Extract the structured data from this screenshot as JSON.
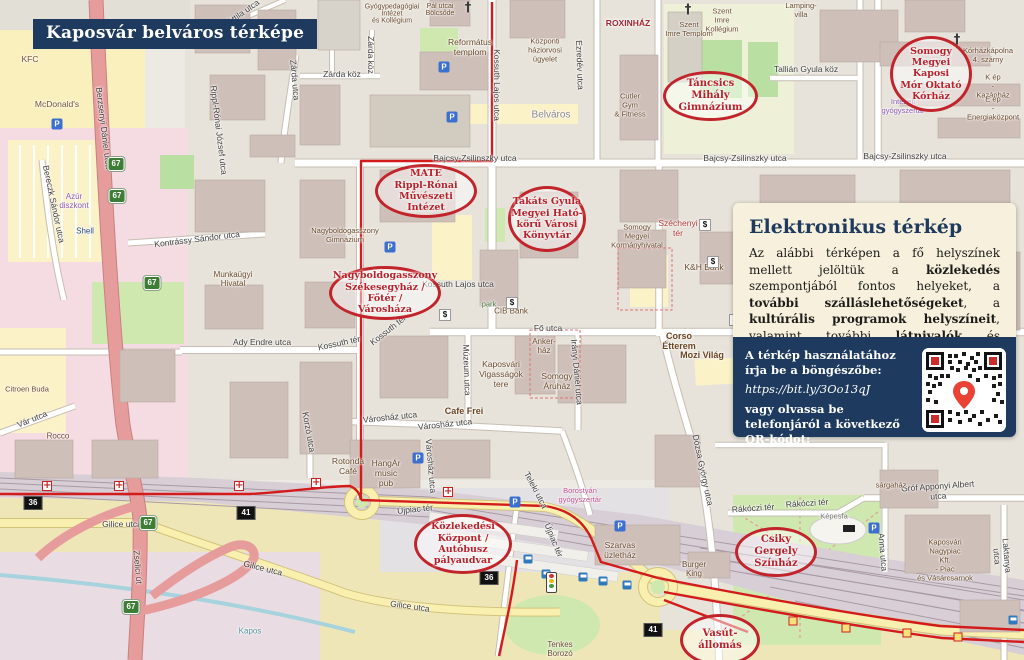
{
  "banner": {
    "title": "Kaposvár belváros térképe"
  },
  "panel": {
    "heading": "Elektronikus térkép",
    "body_segments": [
      {
        "t": "Az alábbi térképen a fő helyszínek mellett jelöltük a "
      },
      {
        "t": "közlekedés",
        "b": 1
      },
      {
        "t": " szempontjából fontos helyeket, a "
      },
      {
        "t": "további szálláslehetőségeket",
        "b": 1
      },
      {
        "t": ", a "
      },
      {
        "t": "kultúrális programok helyszíneit",
        "b": 1
      },
      {
        "t": ", valamint további "
      },
      {
        "t": "látnivalók",
        "b": 1
      },
      {
        "t": " és "
      },
      {
        "t": "élelmiszerüzletek",
        "b": 1
      },
      {
        "t": " címeit."
      }
    ],
    "footer": {
      "line1": "A térkép használatához írja be a böngészőbe:",
      "url": "https://bit.ly/3Oo13qJ",
      "line2": "vagy olvassa be telefonjáról a következő QR-kódot:"
    }
  },
  "colors": {
    "navy": "#1e3a5e",
    "panel_bg": "#f7f0dc",
    "callout_red": "#c2242b",
    "route_red": "#d31b1b",
    "shield_green": "#3e7d35",
    "shield_black": "#111111"
  },
  "map": {
    "glyphs": {
      "parking": "P",
      "atm": "$",
      "church": "†",
      "crossing": "+"
    },
    "callouts": [
      {
        "id": "korhaz",
        "x": 890,
        "y": 36,
        "w": 82,
        "h": 76,
        "fs": 9.5,
        "lines": [
          "Somogy",
          "Megyei Kaposi",
          "Mór Oktató",
          "Kórház"
        ]
      },
      {
        "id": "tancsics",
        "x": 663,
        "y": 71,
        "w": 95,
        "h": 50,
        "fs": 10,
        "lines": [
          "Táncsics Mihály",
          "Gimnázium"
        ]
      },
      {
        "id": "mate",
        "x": 375,
        "y": 164,
        "w": 102,
        "h": 54,
        "fs": 9.5,
        "lines": [
          "MATE",
          "Rippl-Rónai Művészeti",
          "Intézet"
        ]
      },
      {
        "id": "konyvtar",
        "x": 508,
        "y": 186,
        "w": 78,
        "h": 66,
        "fs": 9.5,
        "lines": [
          "Takáts Gyula",
          "Megyei Ható-",
          "körű Városi",
          "Könyvtár"
        ]
      },
      {
        "id": "szekesegyhaz",
        "x": 329,
        "y": 266,
        "w": 112,
        "h": 54,
        "fs": 9.5,
        "lines": [
          "Nagyboldogasszony",
          "Székesegyház / Főtér /",
          "Városháza"
        ]
      },
      {
        "id": "kozlekedesi",
        "x": 414,
        "y": 514,
        "w": 98,
        "h": 60,
        "fs": 9.5,
        "lines": [
          "Közlekedési",
          "Központ / Autóbusz",
          "pályaudvar"
        ]
      },
      {
        "id": "szinhaz",
        "x": 735,
        "y": 527,
        "w": 82,
        "h": 50,
        "fs": 10,
        "lines": [
          "Csiky Gergely",
          "Színház"
        ]
      },
      {
        "id": "vasut",
        "x": 680,
        "y": 614,
        "w": 80,
        "h": 52,
        "fs": 10,
        "lines": [
          "Vasút-",
          "állomás"
        ]
      }
    ],
    "streets": [
      {
        "t": "Bajcsy-Zsilinszky utca",
        "x": 475,
        "y": 158,
        "rot": 0
      },
      {
        "t": "Bajcsy-Zsilinszky utca",
        "x": 745,
        "y": 158,
        "rot": 0
      },
      {
        "t": "Bajcsy-Zsilinszky utca",
        "x": 905,
        "y": 156,
        "rot": 0
      },
      {
        "t": "Kossuth Lajos utca",
        "x": 497,
        "y": 85,
        "rot": 90
      },
      {
        "t": "Kossuth Lajos utca",
        "x": 458,
        "y": 284,
        "rot": 0
      },
      {
        "t": "Zárda utca",
        "x": 295,
        "y": 80,
        "rot": 85
      },
      {
        "t": "Zárda köz",
        "x": 342,
        "y": 74,
        "rot": 0
      },
      {
        "t": "Zárda köz",
        "x": 371,
        "y": 55,
        "rot": 90
      },
      {
        "t": "Fő utca",
        "x": 548,
        "y": 328,
        "rot": 0
      },
      {
        "t": "Kossuth tér",
        "x": 339,
        "y": 343,
        "rot": -12
      },
      {
        "t": "Kossuth tér",
        "x": 388,
        "y": 330,
        "rot": -38
      },
      {
        "t": "Ady Endre utca",
        "x": 262,
        "y": 342,
        "rot": 0
      },
      {
        "t": "Kontrássy Sándor utca",
        "x": 197,
        "y": 239,
        "rot": -7
      },
      {
        "t": "Berzsenyi Dániel utca",
        "x": 104,
        "y": 128,
        "rot": 83
      },
      {
        "t": "Bereczk Sándor utca",
        "x": 54,
        "y": 204,
        "rot": 78
      },
      {
        "t": "Rippl-Rónai József utca",
        "x": 219,
        "y": 130,
        "rot": 83
      },
      {
        "t": "Attila utca",
        "x": 243,
        "y": 12,
        "rot": -35
      },
      {
        "t": "Ezredév utca",
        "x": 580,
        "y": 65,
        "rot": 88
      },
      {
        "t": "Tallián Gyula köz",
        "x": 806,
        "y": 69,
        "rot": 0
      },
      {
        "t": "Irányi Dániel utca",
        "x": 577,
        "y": 372,
        "rot": 85
      },
      {
        "t": "Múzeum utca",
        "x": 467,
        "y": 370,
        "rot": 88
      },
      {
        "t": "Városház utca",
        "x": 390,
        "y": 417,
        "rot": -6
      },
      {
        "t": "Városház utca",
        "x": 445,
        "y": 424,
        "rot": -6
      },
      {
        "t": "Városház utca",
        "x": 431,
        "y": 466,
        "rot": 85
      },
      {
        "t": "Teleki utca",
        "x": 536,
        "y": 490,
        "rot": 62
      },
      {
        "t": "Dózsa György utca",
        "x": 703,
        "y": 470,
        "rot": 78
      },
      {
        "t": "Újpiac tér",
        "x": 415,
        "y": 509,
        "rot": -6
      },
      {
        "t": "Újpiac tér",
        "x": 554,
        "y": 540,
        "rot": 68
      },
      {
        "t": "Gilice utca",
        "x": 122,
        "y": 524,
        "rot": 0
      },
      {
        "t": "Gilice utca",
        "x": 263,
        "y": 568,
        "rot": 14
      },
      {
        "t": "Gilice utca",
        "x": 410,
        "y": 606,
        "rot": 8
      },
      {
        "t": "Zselici út",
        "x": 138,
        "y": 567,
        "rot": 85
      },
      {
        "t": "Vár utca",
        "x": 32,
        "y": 419,
        "rot": -22
      },
      {
        "t": "Rákóczi tér",
        "x": 753,
        "y": 508,
        "rot": -4
      },
      {
        "t": "Rákóczi tér",
        "x": 807,
        "y": 503,
        "rot": -4
      },
      {
        "t": "Gróf Apponyi Albert utca",
        "x": 938,
        "y": 491,
        "rot": -4
      },
      {
        "t": "Anna utca",
        "x": 883,
        "y": 552,
        "rot": 85
      },
      {
        "t": "Laktanya utca",
        "x": 1002,
        "y": 556,
        "rot": 85
      },
      {
        "t": "Korzó utca",
        "x": 309,
        "y": 432,
        "rot": 80
      }
    ],
    "pois": [
      {
        "t": "McDonald's",
        "x": 57,
        "y": 104,
        "fs": 8.5,
        "color": "#7a5034"
      },
      {
        "t": "KFC",
        "x": 30,
        "y": 59,
        "fs": 8.5,
        "color": "#7a5034"
      },
      {
        "t": "Gyógypedagógiai\nIntézet\nés Kollégium",
        "x": 392,
        "y": 14,
        "fs": 7
      },
      {
        "t": "Református\ntemplom",
        "x": 470,
        "y": 47,
        "fs": 8.5
      },
      {
        "t": "Pál utcai\nBölcsőde",
        "x": 440,
        "y": 10,
        "fs": 7
      },
      {
        "t": "Központi\nháziorvosi\nügyelet",
        "x": 545,
        "y": 50,
        "fs": 7.5
      },
      {
        "t": "Belváros",
        "x": 551,
        "y": 115,
        "fs": 10,
        "color": "#8a8a8a"
      },
      {
        "t": "ROXINHÁZ",
        "x": 628,
        "y": 23,
        "fs": 8.5,
        "color": "#a2242f",
        "b": 1
      },
      {
        "t": "Szent\nImre\nKollégium",
        "x": 722,
        "y": 20,
        "fs": 7.5
      },
      {
        "t": "Szent\nImre Templom",
        "x": 689,
        "y": 29,
        "fs": 7.5
      },
      {
        "t": "Lamping-\nvilla",
        "x": 801,
        "y": 10,
        "fs": 7.5
      },
      {
        "t": "Cutler\nGym\n& Fitness",
        "x": 630,
        "y": 105,
        "fs": 7.5
      },
      {
        "t": "Munkaügyi\nHivatal",
        "x": 233,
        "y": 279,
        "fs": 8
      },
      {
        "t": "Nagyboldogasszony\nGimnázium",
        "x": 345,
        "y": 235,
        "fs": 7.5
      },
      {
        "t": "CIB Bank",
        "x": 511,
        "y": 311,
        "fs": 8
      },
      {
        "t": "park",
        "x": 489,
        "y": 304,
        "fs": 7.5,
        "color": "#4c7a3f"
      },
      {
        "t": "Kaposvári\nVigasságok\ntere",
        "x": 501,
        "y": 374,
        "fs": 8.5
      },
      {
        "t": "Somogy\nÁruház",
        "x": 557,
        "y": 381,
        "fs": 8.5
      },
      {
        "t": "Anker-\nház",
        "x": 544,
        "y": 346,
        "fs": 8
      },
      {
        "t": "Cafe Frei",
        "x": 464,
        "y": 411,
        "fs": 9,
        "color": "#6b4423",
        "b": 1
      },
      {
        "t": "Rotonda\nCafé",
        "x": 348,
        "y": 466,
        "fs": 8.5
      },
      {
        "t": "HangÁr\nmusic\npub",
        "x": 386,
        "y": 473,
        "fs": 8.5
      },
      {
        "t": "Somogy\nMegyei\nKormányhivatal",
        "x": 637,
        "y": 236,
        "fs": 7.5
      },
      {
        "t": "K&H Bank",
        "x": 704,
        "y": 267,
        "fs": 8.5
      },
      {
        "t": "Corso\nÉtterem",
        "x": 679,
        "y": 341,
        "fs": 9,
        "color": "#6b4423",
        "b": 1
      },
      {
        "t": "Mozi Világ",
        "x": 702,
        "y": 355,
        "fs": 9,
        "color": "#6b4423",
        "b": 1
      },
      {
        "t": "Széchenyi\ntér",
        "x": 678,
        "y": 228,
        "fs": 8.5,
        "color": "#b03a3a"
      },
      {
        "t": "Szarvas\nüzletház",
        "x": 620,
        "y": 550,
        "fs": 8.5
      },
      {
        "t": "Burger\nKing",
        "x": 694,
        "y": 569,
        "fs": 8
      },
      {
        "t": "Kaposvári\nNagypiac\nKft.\n- Piac\nés Vásárcsarnok",
        "x": 945,
        "y": 560,
        "fs": 7.5
      },
      {
        "t": "sárgaház",
        "x": 891,
        "y": 485,
        "fs": 7.5
      },
      {
        "t": "Képesfa",
        "x": 834,
        "y": 516,
        "fs": 7.5,
        "color": "#777777"
      },
      {
        "t": "Kórházkápolna\n4. szárny",
        "x": 988,
        "y": 55,
        "fs": 7.5
      },
      {
        "t": "K ép\n- Kazánház",
        "x": 993,
        "y": 86,
        "fs": 7.5
      },
      {
        "t": "E ép\n- Energiaközpont",
        "x": 993,
        "y": 108,
        "fs": 7.5
      },
      {
        "t": "Intézeti\ngyógyszertár",
        "x": 903,
        "y": 106,
        "fs": 7.5,
        "color": "#8e5bb5"
      },
      {
        "t": "Azúr\ndiszkont",
        "x": 74,
        "y": 201,
        "fs": 8,
        "color": "#8e5bb5"
      },
      {
        "t": "Shell",
        "x": 85,
        "y": 231,
        "fs": 8,
        "color": "#2a4b8d"
      },
      {
        "t": "Citroen Buda",
        "x": 27,
        "y": 389,
        "fs": 7.5
      },
      {
        "t": "Rocco",
        "x": 58,
        "y": 436,
        "fs": 8
      },
      {
        "t": "Tenkes\nBorozó",
        "x": 560,
        "y": 649,
        "fs": 8
      },
      {
        "t": "Borostyán\ngyógyszertár",
        "x": 580,
        "y": 495,
        "fs": 7.5,
        "color": "#c75093"
      },
      {
        "t": "Kapos",
        "x": 250,
        "y": 631,
        "fs": 8,
        "color": "#5b93a8"
      }
    ],
    "shields_green": [
      {
        "t": "67",
        "x": 116,
        "y": 164
      },
      {
        "t": "67",
        "x": 117,
        "y": 196
      },
      {
        "t": "67",
        "x": 152,
        "y": 283
      },
      {
        "t": "67",
        "x": 148,
        "y": 523
      },
      {
        "t": "67",
        "x": 131,
        "y": 607
      }
    ],
    "shields_black": [
      {
        "t": "36",
        "x": 33,
        "y": 503
      },
      {
        "t": "36",
        "x": 489,
        "y": 578
      },
      {
        "t": "41",
        "x": 246,
        "y": 513
      },
      {
        "t": "41",
        "x": 653,
        "y": 630
      }
    ],
    "crossings": [
      {
        "x": 47,
        "y": 486
      },
      {
        "x": 119,
        "y": 486
      },
      {
        "x": 239,
        "y": 486
      },
      {
        "x": 316,
        "y": 483
      },
      {
        "x": 448,
        "y": 492
      }
    ],
    "parkings": [
      {
        "x": 57,
        "y": 124
      },
      {
        "x": 444,
        "y": 67
      },
      {
        "x": 452,
        "y": 117
      },
      {
        "x": 390,
        "y": 247
      },
      {
        "x": 418,
        "y": 458
      },
      {
        "x": 515,
        "y": 502
      },
      {
        "x": 620,
        "y": 526
      },
      {
        "x": 874,
        "y": 528
      }
    ],
    "buses": [
      {
        "x": 528,
        "y": 559
      },
      {
        "x": 546,
        "y": 574
      },
      {
        "x": 583,
        "y": 577
      },
      {
        "x": 603,
        "y": 581
      },
      {
        "x": 627,
        "y": 585
      },
      {
        "x": 1013,
        "y": 620
      }
    ],
    "atms": [
      {
        "x": 445,
        "y": 315
      },
      {
        "x": 512,
        "y": 303
      },
      {
        "x": 705,
        "y": 225
      },
      {
        "x": 713,
        "y": 262
      },
      {
        "x": 735,
        "y": 320
      }
    ],
    "churches": [
      {
        "x": 468,
        "y": 8
      },
      {
        "x": 688,
        "y": 10
      },
      {
        "x": 957,
        "y": 40
      }
    ],
    "route_markers": [
      {
        "x": 793,
        "y": 621
      },
      {
        "x": 846,
        "y": 628
      },
      {
        "x": 907,
        "y": 633
      },
      {
        "x": 958,
        "y": 637
      }
    ]
  }
}
